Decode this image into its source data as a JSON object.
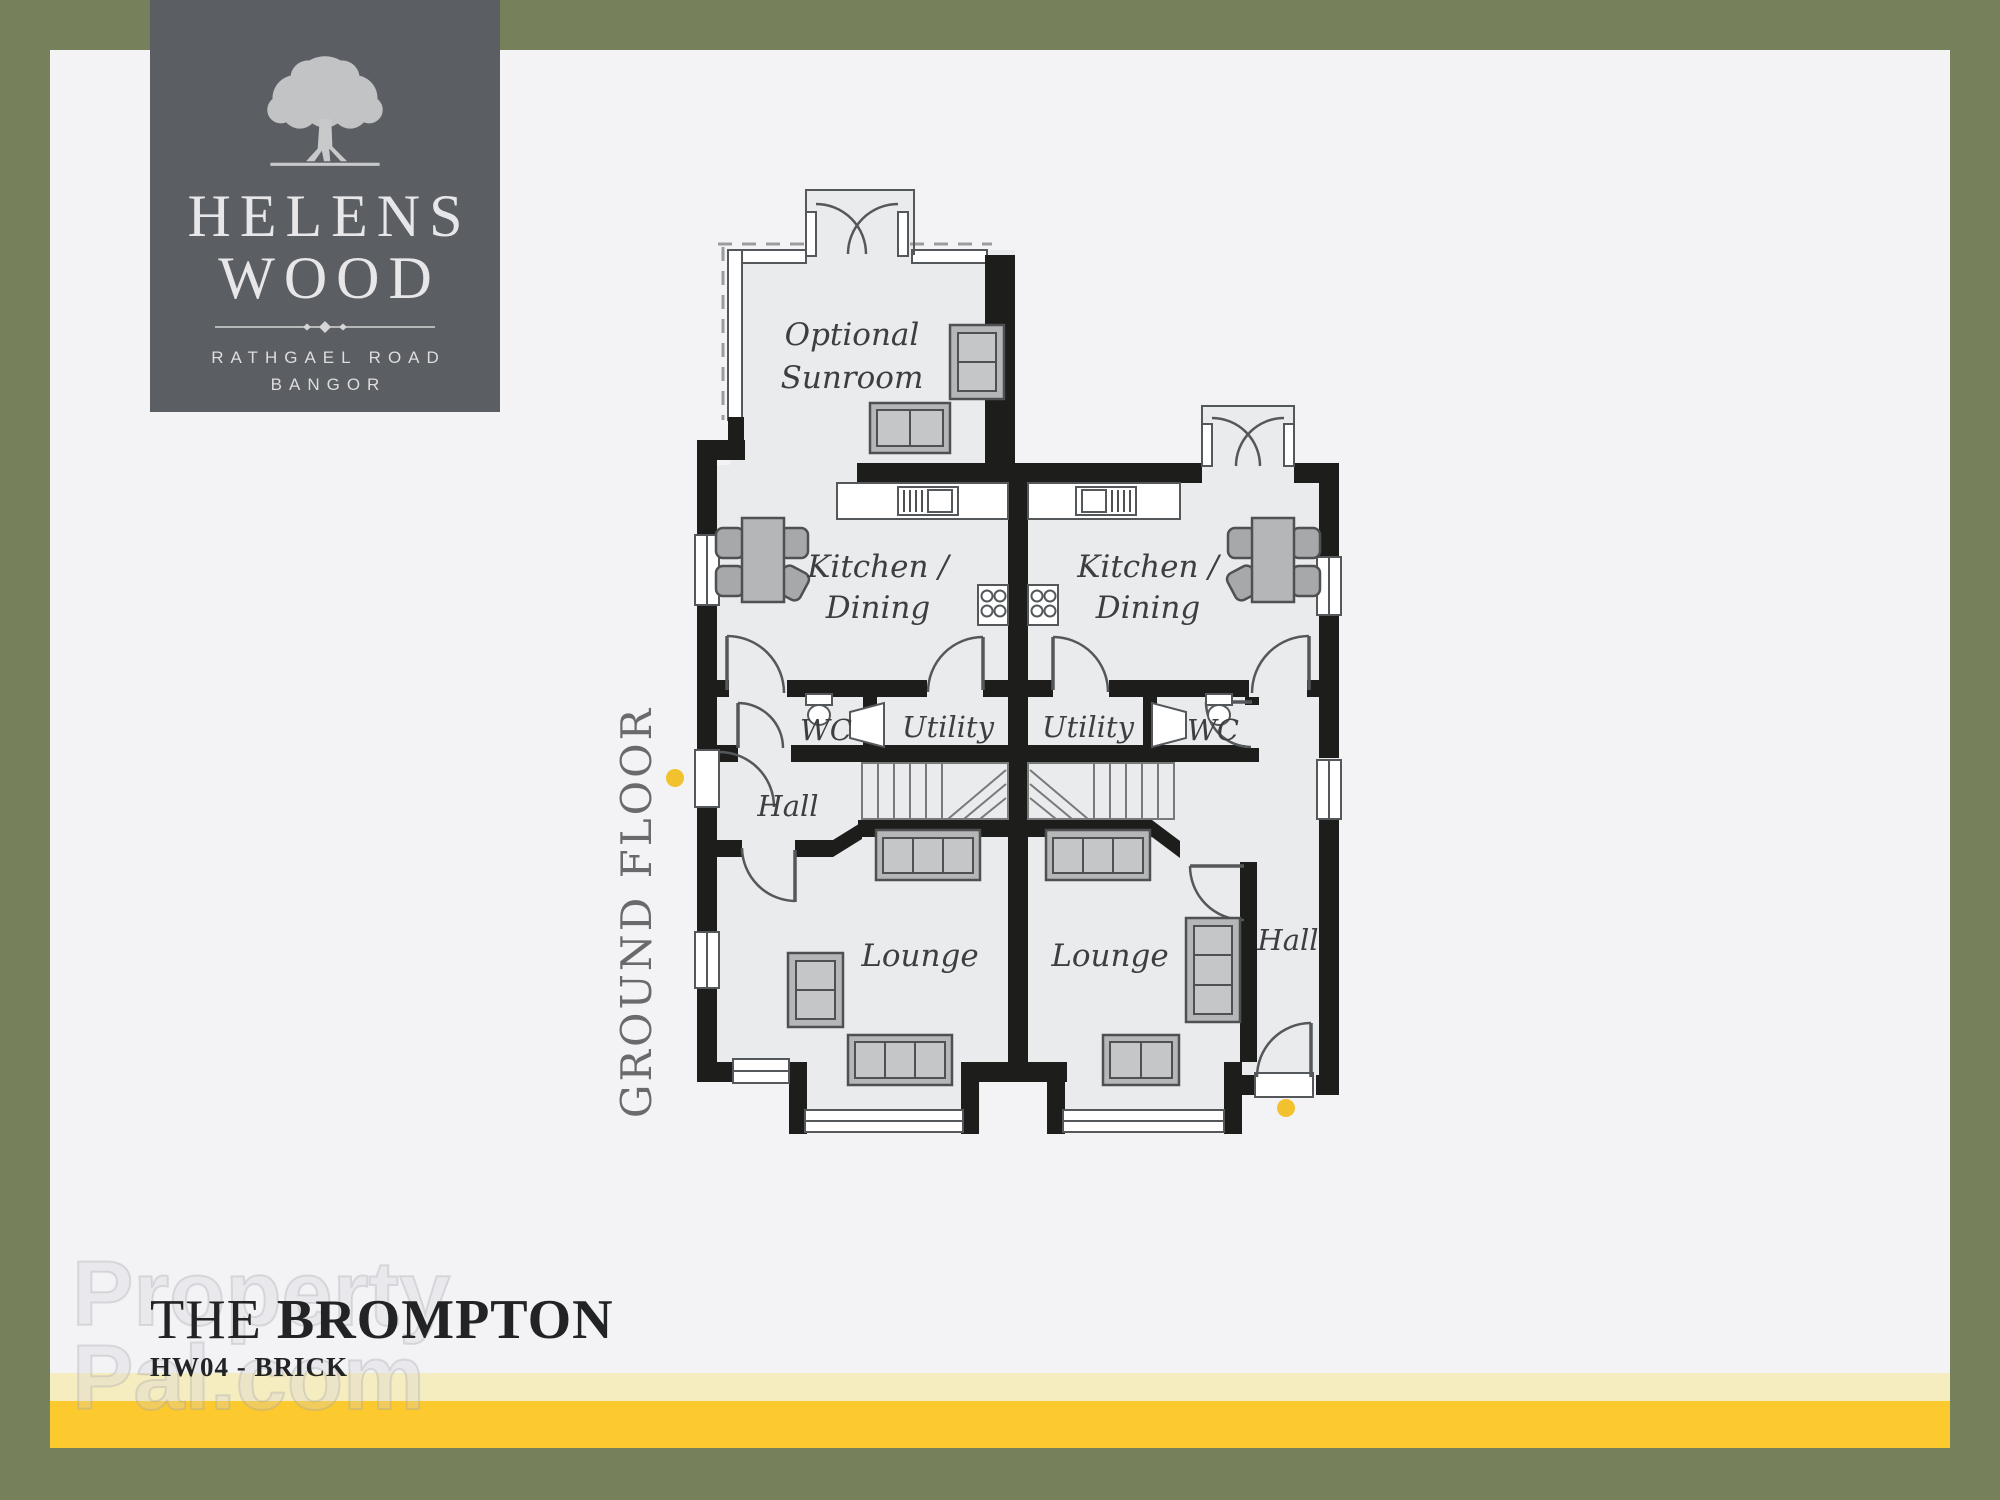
{
  "logo": {
    "name_line1": "HELENS",
    "name_line2": "WOOD",
    "address_line1": "RATHGAEL ROAD",
    "address_line2": "BANGOR"
  },
  "plan": {
    "floor_label": "GROUND FLOOR",
    "rooms": {
      "sunroom_line1": "Optional",
      "sunroom_line2": "Sunroom",
      "kitchen_line1": "Kitchen /",
      "kitchen_line2": "Dining",
      "utility": "Utility",
      "wc": "WC",
      "hall": "Hall",
      "lounge": "Lounge"
    },
    "entrance_marker_color": "#f2c12e"
  },
  "footer": {
    "title_prefix": "THE",
    "title_name": "BROMPTON",
    "subtitle": "HW04 - BRICK"
  },
  "watermark": {
    "line1": "Property",
    "line2": "Pal.com"
  },
  "colors": {
    "border_olive": "#76815b",
    "background": "#f3f3f5",
    "logo_panel": "#5b5e63",
    "gold_bar": "#fcca2e",
    "pale_gold_bar": "#f5ecc0",
    "plan_floor": "#e9ebed",
    "wall": "#1d1d1b",
    "floor_label_gray": "#6a6a6c"
  }
}
